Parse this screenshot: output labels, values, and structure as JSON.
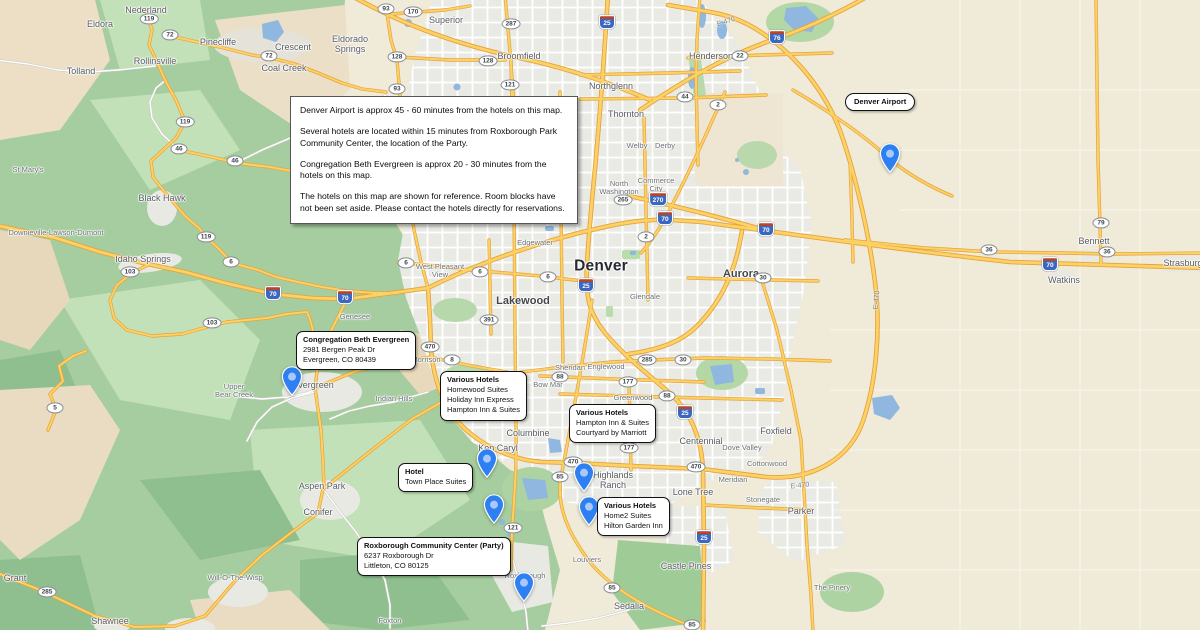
{
  "info_box": {
    "paragraphs": [
      "Denver Airport is approx 45 - 60 minutes from the hotels on this map.",
      "Several hotels are located within 15 minutes from Roxborough Park Community Center, the location of the Party.",
      "Congregation Beth Evergreen is approx 20 - 30 minutes from the hotels on this map.",
      "The hotels on this map are shown for reference.  Room blocks have not been set aside.  Please contact the hotels directly for reservations."
    ]
  },
  "annotations": [
    {
      "title": "Denver Airport",
      "lines": []
    },
    {
      "title": "Congregation Beth Evergreen",
      "lines": [
        "2981 Bergen Peak Dr",
        "Evergreen, CO 80439"
      ]
    },
    {
      "title": "Various Hotels",
      "lines": [
        "Homewood Suites",
        "Holiday Inn Express",
        "Hampton Inn & Suites"
      ]
    },
    {
      "title": "Various Hotels",
      "lines": [
        "Hampton Inn & Suites",
        "Courtyard by Marriott"
      ]
    },
    {
      "title": "Hotel",
      "lines": [
        "Town Place Suites"
      ]
    },
    {
      "title": "Various Hotels",
      "lines": [
        "Home2 Suites",
        "Hilton Garden Inn"
      ]
    },
    {
      "title": "Roxborough Community Center (Party)",
      "lines": [
        "6237 Roxborough Dr",
        "Littleton, CO 80125"
      ]
    }
  ],
  "icons": {
    "map_pin": "blue-teardrop-marker"
  },
  "map": {
    "colors": {
      "pin_blue": "#2e80f2",
      "pin_inner": "#a9c9fb",
      "water": "#8fb7e0",
      "road_yellow": "#fcd165",
      "road_casing": "#e5a33c",
      "mountain_green": "#a6cd9f",
      "urban_gray": "#e9eae4",
      "plains_tan": "#f0ead9"
    },
    "city_labels": [
      {
        "text": "Nederland",
        "x": 146,
        "y": 11,
        "size": "sm"
      },
      {
        "text": "Eldora",
        "x": 100,
        "y": 25,
        "size": "sm"
      },
      {
        "text": "Pinecliffe",
        "x": 218,
        "y": 43,
        "size": "sm"
      },
      {
        "text": "Crescent",
        "x": 293,
        "y": 48,
        "size": "sm"
      },
      {
        "text": "Coal Creek",
        "x": 284,
        "y": 69,
        "size": "sm"
      },
      {
        "text": "Rollinsville",
        "x": 155,
        "y": 62,
        "size": "sm"
      },
      {
        "text": "Tolland",
        "x": 81,
        "y": 72,
        "size": "sm"
      },
      {
        "text": "Eldorado\nSprings",
        "x": 350,
        "y": 45,
        "size": "sm"
      },
      {
        "text": "Superior",
        "x": 446,
        "y": 21,
        "size": "sm"
      },
      {
        "text": "Broomfield",
        "x": 519,
        "y": 57,
        "size": "sm"
      },
      {
        "text": "Northglenn",
        "x": 611,
        "y": 87,
        "size": "sm"
      },
      {
        "text": "Henderson",
        "x": 711,
        "y": 57,
        "size": "sm"
      },
      {
        "text": "Thornton",
        "x": 626,
        "y": 115,
        "size": "sm"
      },
      {
        "text": "Welby",
        "x": 637,
        "y": 146,
        "size": "xs"
      },
      {
        "text": "Derby",
        "x": 665,
        "y": 146,
        "size": "xs"
      },
      {
        "text": "North\nWashington",
        "x": 619,
        "y": 188,
        "size": "xs"
      },
      {
        "text": "Commerce\nCity",
        "x": 656,
        "y": 185,
        "size": "xs"
      },
      {
        "text": "Edgewater",
        "x": 535,
        "y": 243,
        "size": "xs"
      },
      {
        "text": "Denver",
        "x": 601,
        "y": 266,
        "size": "lg"
      },
      {
        "text": "Aurora",
        "x": 741,
        "y": 274,
        "size": "md"
      },
      {
        "text": "Glendale",
        "x": 645,
        "y": 297,
        "size": "xs"
      },
      {
        "text": "Lakewood",
        "x": 523,
        "y": 301,
        "size": "md"
      },
      {
        "text": "West Pleasant\nView",
        "x": 440,
        "y": 271,
        "size": "xs"
      },
      {
        "text": "Genesee",
        "x": 355,
        "y": 317,
        "size": "xs"
      },
      {
        "text": "Morrison",
        "x": 426,
        "y": 360,
        "size": "xs"
      },
      {
        "text": "Sheridan",
        "x": 570,
        "y": 368,
        "size": "xs"
      },
      {
        "text": "Englewood",
        "x": 606,
        "y": 367,
        "size": "xs"
      },
      {
        "text": "Bow Mar",
        "x": 548,
        "y": 385,
        "size": "xs"
      },
      {
        "text": "Greenwood",
        "x": 633,
        "y": 398,
        "size": "xs"
      },
      {
        "text": "Columbine",
        "x": 528,
        "y": 434,
        "size": "sm"
      },
      {
        "text": "Ken Caryl",
        "x": 498,
        "y": 449,
        "size": "sm"
      },
      {
        "text": "Indian Hills",
        "x": 394,
        "y": 399,
        "size": "xs"
      },
      {
        "text": "Highlands\nRanch",
        "x": 613,
        "y": 481,
        "size": "sm"
      },
      {
        "text": "Centennial",
        "x": 701,
        "y": 442,
        "size": "sm"
      },
      {
        "text": "Dove Valley",
        "x": 742,
        "y": 448,
        "size": "xs"
      },
      {
        "text": "Foxfield",
        "x": 776,
        "y": 432,
        "size": "sm"
      },
      {
        "text": "Cottonwood",
        "x": 767,
        "y": 464,
        "size": "xs"
      },
      {
        "text": "Meridian",
        "x": 733,
        "y": 480,
        "size": "xs"
      },
      {
        "text": "Lone Tree",
        "x": 693,
        "y": 493,
        "size": "sm"
      },
      {
        "text": "Stonegate",
        "x": 763,
        "y": 500,
        "size": "xs"
      },
      {
        "text": "Parker",
        "x": 801,
        "y": 512,
        "size": "sm"
      },
      {
        "text": "Castle Pines",
        "x": 686,
        "y": 567,
        "size": "sm"
      },
      {
        "text": "Louviers",
        "x": 587,
        "y": 560,
        "size": "xs"
      },
      {
        "text": "Sedalia",
        "x": 629,
        "y": 607,
        "size": "sm"
      },
      {
        "text": "Roxborough\nPark",
        "x": 525,
        "y": 580,
        "size": "xs"
      },
      {
        "text": "The Pinery",
        "x": 832,
        "y": 588,
        "size": "xs"
      },
      {
        "text": "Upper\nBear Creek",
        "x": 234,
        "y": 391,
        "size": "xs"
      },
      {
        "text": "Evergreen",
        "x": 313,
        "y": 386,
        "size": "sm"
      },
      {
        "text": "Aspen Park",
        "x": 322,
        "y": 487,
        "size": "sm"
      },
      {
        "text": "Conifer",
        "x": 318,
        "y": 513,
        "size": "sm"
      },
      {
        "text": "Will-O-The-Wisp",
        "x": 235,
        "y": 578,
        "size": "xs"
      },
      {
        "text": "Shawnee",
        "x": 110,
        "y": 622,
        "size": "sm"
      },
      {
        "text": "Grant",
        "x": 15,
        "y": 579,
        "size": "sm"
      },
      {
        "text": "Foxton",
        "x": 390,
        "y": 621,
        "size": "xs"
      },
      {
        "text": "St Mary's",
        "x": 28,
        "y": 170,
        "size": "xs"
      },
      {
        "text": "Black Hawk",
        "x": 162,
        "y": 199,
        "size": "sm"
      },
      {
        "text": "Downieville-Lawson-Dumont",
        "x": 56,
        "y": 233,
        "size": "xs"
      },
      {
        "text": "Idaho Springs",
        "x": 143,
        "y": 260,
        "size": "sm"
      },
      {
        "text": "Watkins",
        "x": 1064,
        "y": 281,
        "size": "sm"
      },
      {
        "text": "Bennett",
        "x": 1094,
        "y": 242,
        "size": "sm"
      },
      {
        "text": "Strasburg",
        "x": 1183,
        "y": 264,
        "size": "sm"
      }
    ],
    "highway_shields": [
      {
        "num": "119",
        "x": 149,
        "y": 19,
        "type": "st"
      },
      {
        "num": "72",
        "x": 170,
        "y": 35,
        "type": "st"
      },
      {
        "num": "72",
        "x": 269,
        "y": 56,
        "type": "st"
      },
      {
        "num": "119",
        "x": 185,
        "y": 122,
        "type": "st"
      },
      {
        "num": "46",
        "x": 179,
        "y": 149,
        "type": "st"
      },
      {
        "num": "46",
        "x": 235,
        "y": 161,
        "type": "st"
      },
      {
        "num": "119",
        "x": 206,
        "y": 237,
        "type": "st"
      },
      {
        "num": "6",
        "x": 231,
        "y": 262,
        "type": "st"
      },
      {
        "num": "103",
        "x": 130,
        "y": 272,
        "type": "st"
      },
      {
        "num": "103",
        "x": 212,
        "y": 323,
        "type": "st"
      },
      {
        "num": "93",
        "x": 386,
        "y": 9,
        "type": "st"
      },
      {
        "num": "170",
        "x": 413,
        "y": 12,
        "type": "st"
      },
      {
        "num": "128",
        "x": 397,
        "y": 57,
        "type": "st"
      },
      {
        "num": "128",
        "x": 488,
        "y": 61,
        "type": "st"
      },
      {
        "num": "287",
        "x": 511,
        "y": 24,
        "type": "st"
      },
      {
        "num": "121",
        "x": 510,
        "y": 85,
        "type": "st"
      },
      {
        "num": "93",
        "x": 397,
        "y": 89,
        "type": "st"
      },
      {
        "num": "22",
        "x": 740,
        "y": 56,
        "type": "st"
      },
      {
        "num": "44",
        "x": 685,
        "y": 97,
        "type": "st"
      },
      {
        "num": "2",
        "x": 718,
        "y": 105,
        "type": "st"
      },
      {
        "num": "265",
        "x": 623,
        "y": 200,
        "type": "st"
      },
      {
        "num": "2",
        "x": 646,
        "y": 237,
        "type": "st"
      },
      {
        "num": "30",
        "x": 763,
        "y": 278,
        "type": "st"
      },
      {
        "num": "391",
        "x": 489,
        "y": 320,
        "type": "st"
      },
      {
        "num": "8",
        "x": 452,
        "y": 360,
        "type": "st"
      },
      {
        "num": "88",
        "x": 560,
        "y": 377,
        "type": "st"
      },
      {
        "num": "177",
        "x": 628,
        "y": 382,
        "type": "st"
      },
      {
        "num": "88",
        "x": 667,
        "y": 396,
        "type": "st"
      },
      {
        "num": "470",
        "x": 430,
        "y": 347,
        "type": "st"
      },
      {
        "num": "470",
        "x": 573,
        "y": 462,
        "type": "st"
      },
      {
        "num": "470",
        "x": 696,
        "y": 467,
        "type": "st"
      },
      {
        "num": "85",
        "x": 560,
        "y": 477,
        "type": "st"
      },
      {
        "num": "177",
        "x": 629,
        "y": 448,
        "type": "st"
      },
      {
        "num": "121",
        "x": 513,
        "y": 528,
        "type": "st"
      },
      {
        "num": "85",
        "x": 612,
        "y": 588,
        "type": "st"
      },
      {
        "num": "85",
        "x": 692,
        "y": 625,
        "type": "st"
      },
      {
        "num": "285",
        "x": 647,
        "y": 360,
        "type": "st"
      },
      {
        "num": "30",
        "x": 683,
        "y": 360,
        "type": "st"
      },
      {
        "num": "79",
        "x": 1101,
        "y": 223,
        "type": "st"
      },
      {
        "num": "36",
        "x": 989,
        "y": 250,
        "type": "st"
      },
      {
        "num": "36",
        "x": 1107,
        "y": 252,
        "type": "st"
      },
      {
        "num": "6",
        "x": 406,
        "y": 263,
        "type": "st"
      },
      {
        "num": "6",
        "x": 480,
        "y": 272,
        "type": "st"
      },
      {
        "num": "6",
        "x": 548,
        "y": 277,
        "type": "st"
      },
      {
        "num": "5",
        "x": 55,
        "y": 408,
        "type": "st"
      },
      {
        "num": "285",
        "x": 47,
        "y": 592,
        "type": "st"
      },
      {
        "num": "25",
        "x": 607,
        "y": 22,
        "type": "i"
      },
      {
        "num": "25",
        "x": 586,
        "y": 285,
        "type": "i"
      },
      {
        "num": "25",
        "x": 685,
        "y": 412,
        "type": "i"
      },
      {
        "num": "25",
        "x": 704,
        "y": 537,
        "type": "i"
      },
      {
        "num": "70",
        "x": 273,
        "y": 293,
        "type": "i"
      },
      {
        "num": "70",
        "x": 345,
        "y": 297,
        "type": "i"
      },
      {
        "num": "70",
        "x": 665,
        "y": 218,
        "type": "i"
      },
      {
        "num": "70",
        "x": 766,
        "y": 229,
        "type": "i"
      },
      {
        "num": "70",
        "x": 1050,
        "y": 264,
        "type": "i"
      },
      {
        "num": "76",
        "x": 777,
        "y": 37,
        "type": "i"
      },
      {
        "num": "270",
        "x": 658,
        "y": 199,
        "type": "i"
      }
    ],
    "road_labels": [
      {
        "text": "E-470",
        "x": 726,
        "y": 22,
        "angle": -18
      },
      {
        "text": "E-470",
        "x": 800,
        "y": 486,
        "angle": -6
      },
      {
        "text": "E-470",
        "x": 877,
        "y": 300,
        "angle": -85
      }
    ]
  }
}
